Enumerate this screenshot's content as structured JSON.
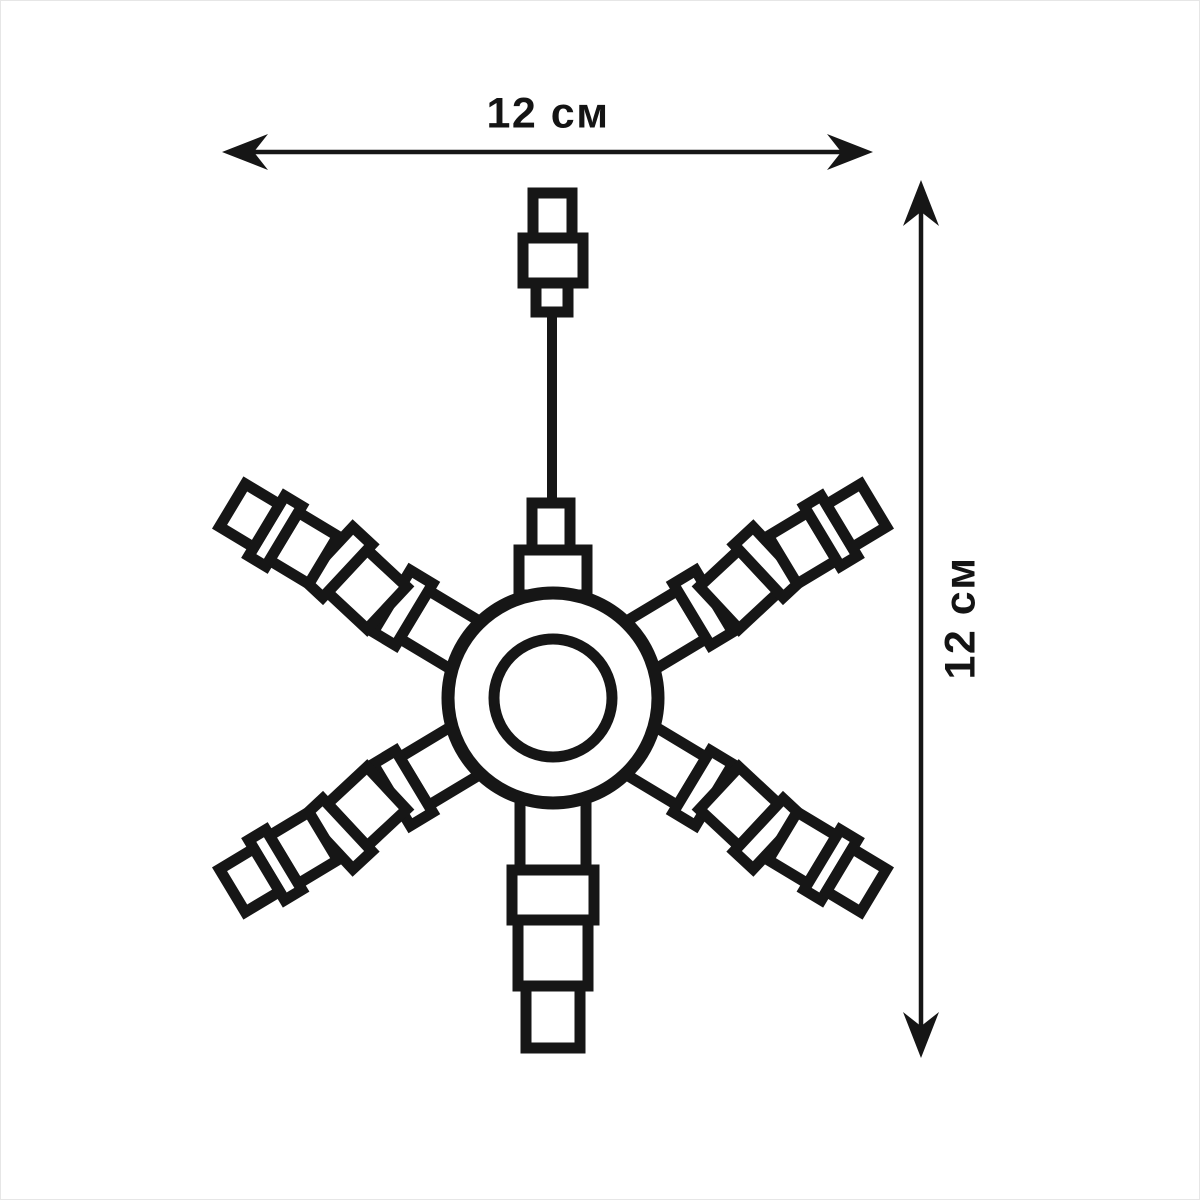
{
  "diagram": {
    "type": "technical-dimension-drawing",
    "subject": "six-arm segmented snowflake decoration with power plug and cord",
    "background_color": "#ffffff",
    "line_color": "#161616",
    "width_dimension": {
      "label": "12 см",
      "value": 12,
      "unit": "см"
    },
    "height_dimension": {
      "label": "12 см",
      "value": 12,
      "unit": "см"
    }
  }
}
